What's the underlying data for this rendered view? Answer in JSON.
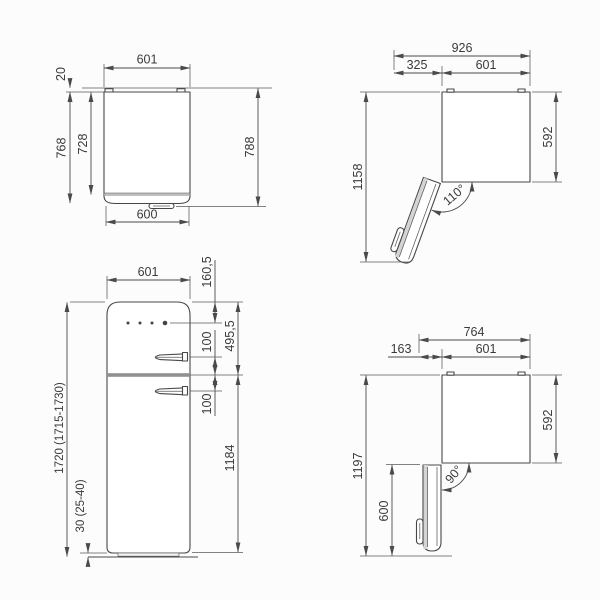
{
  "meta": {
    "type": "technical dimension drawing",
    "subject": "refrigerator installation dimensions",
    "units": "mm"
  },
  "colors": {
    "background": "#fcfcfc",
    "line": "#474747",
    "text": "#3a3a3a",
    "shade_light": "#d4d4d4",
    "shade_mid": "#b3b3b3",
    "shade_dark": "#909090"
  },
  "views": {
    "top_closed": {
      "title": "top view, door closed",
      "dims": {
        "width": "601",
        "wall_gap": "20",
        "depth_with_door": "768",
        "depth_cabinet": "728",
        "depth_overall": "788",
        "front_width": "600"
      }
    },
    "top_open_110": {
      "title": "top view, door open 110 degrees",
      "dims": {
        "overall_width": "926",
        "door_clearance": "325",
        "width": "601",
        "depth": "592",
        "overall_depth": "1158",
        "door_angle": "110°"
      }
    },
    "front": {
      "title": "front view",
      "dims": {
        "width": "601",
        "top_to_controls": "160,5",
        "top_to_door_split": "495,5",
        "upper_handle_offset": "100",
        "lower_handle_offset": "100",
        "lower_door_height": "1184",
        "overall_height": "1720 (1715-1730)",
        "feet_height": "30 (25-40)"
      }
    },
    "top_open_90": {
      "title": "top view, door open 90 degrees",
      "dims": {
        "overall_width": "764",
        "door_clearance": "163",
        "width": "601",
        "depth": "592",
        "overall_depth": "1197",
        "door_projection": "600",
        "door_angle": "90°"
      }
    }
  }
}
